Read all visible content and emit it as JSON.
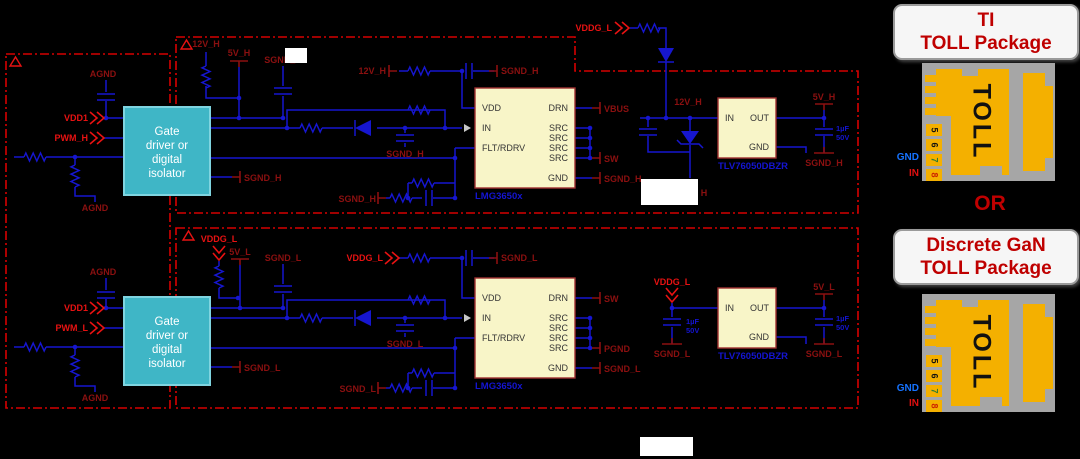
{
  "right_panel": {
    "card1": {
      "line1": "TI",
      "line2": "TOLL Package"
    },
    "or_text": "OR",
    "card2": {
      "line1": "Discrete GaN",
      "line2": "TOLL Package"
    },
    "package": {
      "toll": "TOLL",
      "pins": [
        "5",
        "6",
        "7",
        "8"
      ],
      "pin_colors": [
        "#111111",
        "#111111",
        "#2e7d32",
        "#cc2200"
      ],
      "gnd": "GND",
      "in": "IN"
    }
  },
  "schematic": {
    "driver": {
      "lines": [
        "Gate",
        "driver or",
        "digital",
        "isolator"
      ]
    },
    "gan": {
      "part": "LMG3650x",
      "left": [
        "VDD",
        "IN",
        "FLT/RDRV"
      ],
      "right": [
        "DRN",
        "SRC",
        "SRC",
        "SRC",
        "SRC",
        "GND"
      ]
    },
    "ldo": {
      "part": "TLV76050DBZR",
      "left": [
        "IN"
      ],
      "right": [
        "OUT",
        "GND"
      ]
    },
    "colors": {
      "wire": "#1616cf",
      "net_label": "#8b1010",
      "flag_label": "#e81212",
      "boundary": "#d60000",
      "part_label": "#1414d0",
      "ic_fill": "#f8f5c8",
      "driver_fill": "#3fb6c6"
    },
    "labels": [
      {
        "t": "AGND",
        "x": 103,
        "y": 77
      },
      {
        "t": "VDD1",
        "x": 88,
        "y": 121,
        "a": "e",
        "c": "b"
      },
      {
        "t": "PWM_H",
        "x": 88,
        "y": 141,
        "a": "e",
        "c": "b"
      },
      {
        "t": "AGND",
        "x": 95,
        "y": 211
      },
      {
        "t": "12V_H",
        "x": 206,
        "y": 47
      },
      {
        "t": "5V_H",
        "x": 239,
        "y": 56
      },
      {
        "t": "SGND_H",
        "x": 283,
        "y": 63
      },
      {
        "t": "12V_H",
        "x": 386,
        "y": 74,
        "a": "e"
      },
      {
        "t": "SGND_H",
        "x": 501,
        "y": 74,
        "a": "s"
      },
      {
        "t": "SGND_H",
        "x": 405,
        "y": 157
      },
      {
        "t": "SGND_H",
        "x": 244,
        "y": 181,
        "a": "s"
      },
      {
        "t": "SGND_H",
        "x": 376,
        "y": 202,
        "a": "e"
      },
      {
        "t": "VBUS",
        "x": 604,
        "y": 112,
        "a": "s"
      },
      {
        "t": "SW",
        "x": 604,
        "y": 162,
        "a": "s"
      },
      {
        "t": "SGND_H",
        "x": 604,
        "y": 182,
        "a": "s"
      },
      {
        "t": "12V_H",
        "x": 688,
        "y": 105
      },
      {
        "t": "5V_H",
        "x": 824,
        "y": 100
      },
      {
        "t": "1µF",
        "x": 836,
        "y": 131,
        "a": "s",
        "c": "u",
        "f": 7.5
      },
      {
        "t": "50V",
        "x": 836,
        "y": 140,
        "a": "s",
        "c": "u",
        "f": 7.5
      },
      {
        "t": "SGND_H",
        "x": 824,
        "y": 166
      },
      {
        "t": "VDDG_L",
        "x": 612,
        "y": 31,
        "a": "e",
        "c": "b"
      },
      {
        "t": "H",
        "x": 704,
        "y": 196
      },
      {
        "t": "AGND",
        "x": 103,
        "y": 275
      },
      {
        "t": "VDD1",
        "x": 88,
        "y": 311,
        "a": "e",
        "c": "b"
      },
      {
        "t": "PWM_L",
        "x": 88,
        "y": 331,
        "a": "e",
        "c": "b"
      },
      {
        "t": "AGND",
        "x": 95,
        "y": 401
      },
      {
        "t": "VDDG_L",
        "x": 219,
        "y": 242,
        "c": "b"
      },
      {
        "t": "5V_L",
        "x": 240,
        "y": 255
      },
      {
        "t": "SGND_L",
        "x": 283,
        "y": 261
      },
      {
        "t": "VDDG_L",
        "x": 383,
        "y": 261,
        "a": "e",
        "c": "b"
      },
      {
        "t": "SGND_L",
        "x": 501,
        "y": 261,
        "a": "s"
      },
      {
        "t": "SGND_L",
        "x": 405,
        "y": 347
      },
      {
        "t": "SGND_L",
        "x": 244,
        "y": 371,
        "a": "s"
      },
      {
        "t": "SGND_L",
        "x": 376,
        "y": 392,
        "a": "e"
      },
      {
        "t": "SW",
        "x": 604,
        "y": 302,
        "a": "s"
      },
      {
        "t": "PGND",
        "x": 604,
        "y": 352,
        "a": "s"
      },
      {
        "t": "SGND_L",
        "x": 604,
        "y": 372,
        "a": "s"
      },
      {
        "t": "VDDG_L",
        "x": 672,
        "y": 285,
        "c": "b"
      },
      {
        "t": "5V_L",
        "x": 824,
        "y": 290
      },
      {
        "t": "1µF",
        "x": 686,
        "y": 324,
        "a": "s",
        "c": "u",
        "f": 7.5
      },
      {
        "t": "50V",
        "x": 686,
        "y": 333,
        "a": "s",
        "c": "u",
        "f": 7.5
      },
      {
        "t": "SGND_L",
        "x": 672,
        "y": 357
      },
      {
        "t": "1µF",
        "x": 836,
        "y": 321,
        "a": "s",
        "c": "u",
        "f": 7.5
      },
      {
        "t": "50V",
        "x": 836,
        "y": 330,
        "a": "s",
        "c": "u",
        "f": 7.5
      },
      {
        "t": "SGND_L",
        "x": 824,
        "y": 357
      }
    ]
  }
}
